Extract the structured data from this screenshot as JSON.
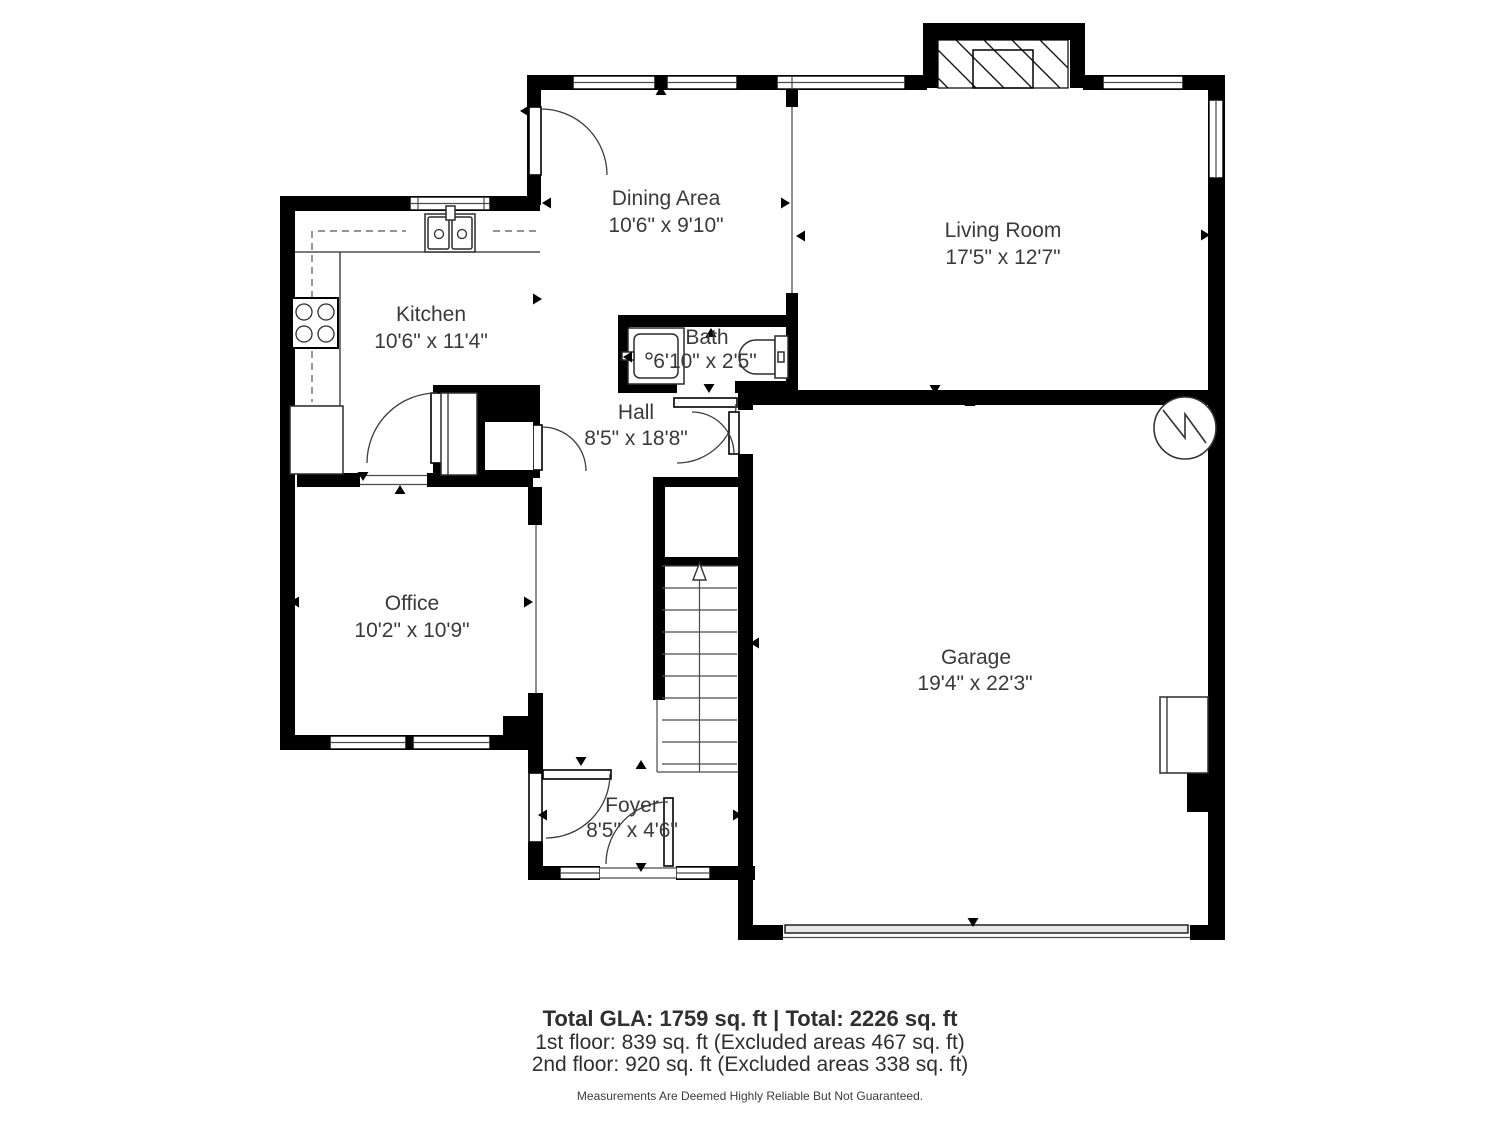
{
  "plan": {
    "rooms": [
      {
        "name": "Dining Area",
        "dims": "10'6\" x 9'10\""
      },
      {
        "name": "Living Room",
        "dims": "17'5\" x 12'7\""
      },
      {
        "name": "Kitchen",
        "dims": "10'6\" x 11'4\""
      },
      {
        "name": "Bath",
        "dims": "6'10\" x 2'5\""
      },
      {
        "name": "Hall",
        "dims": "8'5\" x 18'8\""
      },
      {
        "name": "Office",
        "dims": "10'2\" x 10'9\""
      },
      {
        "name": "Garage",
        "dims": "19'4\" x 22'3\""
      },
      {
        "name": "Foyer",
        "dims": "8'5\" x 4'6\""
      }
    ],
    "fixtures": [
      "stove-icon",
      "kitchen-sink-icon",
      "refrigerator-icon",
      "bath-sink-icon",
      "toilet-icon",
      "water-heater-icon",
      "fireplace-icon",
      "staircase-up-icon",
      "garage-door-icon",
      "front-door-icon"
    ]
  },
  "footer": {
    "summary": "Total GLA: 1759 sq. ft | Total: 2226 sq. ft",
    "first_floor": "1st floor: 839 sq. ft (Excluded areas 467 sq. ft)",
    "second_floor": "2nd floor: 920 sq. ft (Excluded areas 338 sq. ft)",
    "disclaimer": "Measurements Are Deemed Highly Reliable But Not Guaranteed."
  },
  "colors": {
    "wall": "#000000",
    "line": "#3c3c3c",
    "text": "#3a3a3a",
    "background": "#ffffff"
  }
}
